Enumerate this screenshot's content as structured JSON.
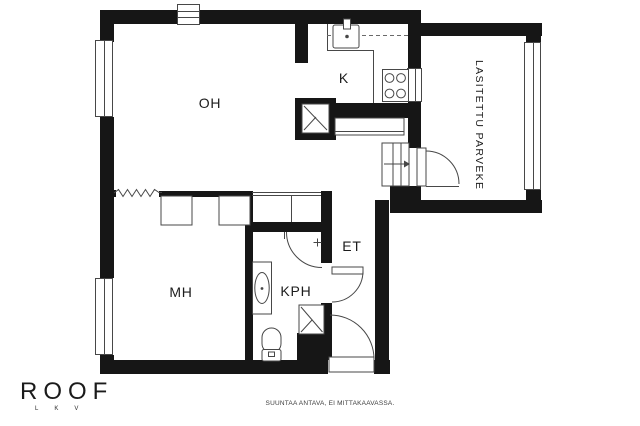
{
  "floorplan": {
    "rooms": {
      "living_room": {
        "label": "OH"
      },
      "kitchen": {
        "label": "K"
      },
      "bedroom": {
        "label": "MH"
      },
      "bathroom": {
        "label": "KPH"
      },
      "hallway": {
        "label": "ET"
      },
      "balcony": {
        "label": "LASITETTU PARVEKE"
      }
    },
    "colors": {
      "wall": "#161616",
      "line": "#474747",
      "background": "#ffffff"
    }
  },
  "branding": {
    "logo": "ROOF",
    "logo_sub": "LKV"
  },
  "footer": {
    "disclaimer": "SUUNTAA ANTAVA, EI MITTAKAAVASSA."
  }
}
